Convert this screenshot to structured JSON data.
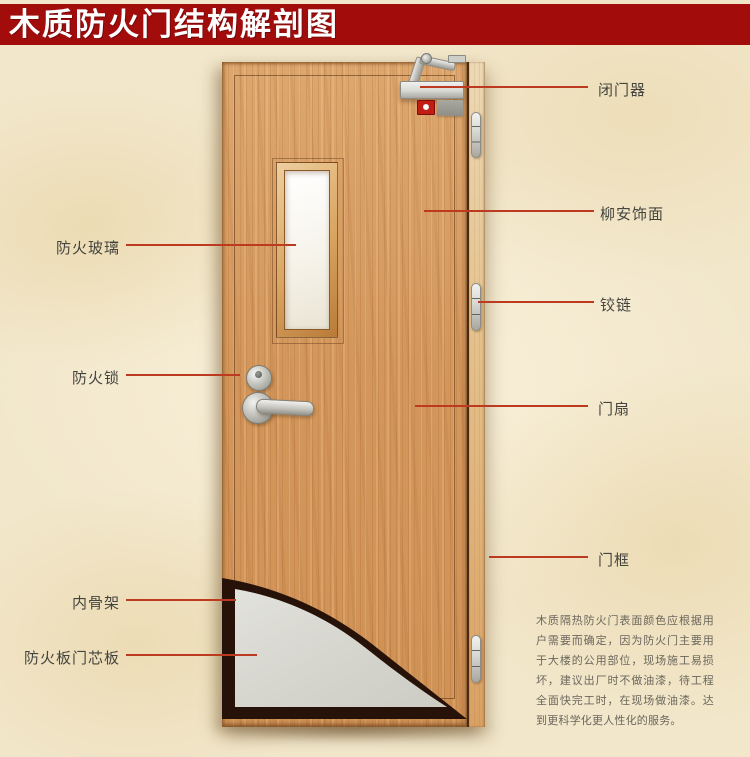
{
  "title": {
    "text": "木质防火门结构解剖图"
  },
  "callouts": {
    "left": [
      {
        "label": "防火玻璃"
      },
      {
        "label": "防火锁"
      },
      {
        "label": "内骨架"
      },
      {
        "label": "防火板门芯板"
      }
    ],
    "right": [
      {
        "label": "闭门器"
      },
      {
        "label": "柳安饰面"
      },
      {
        "label": "铰链"
      },
      {
        "label": "门扇"
      },
      {
        "label": "门框"
      }
    ]
  },
  "note": {
    "text": "木质隔热防火门表面颜色应根据用户需要而确定，因为防火门主要用于大楼的公用部位，现场施工易损坏，建议出厂时不做油漆，待工程全面快完工时，在现场做油漆。达到更科学化更人性化的服务。"
  },
  "colors": {
    "banner": "#a20d0c",
    "callout_line": "#bc3a20",
    "wood": "#d4975b",
    "core_board": "#d9d9d1",
    "inner_frame": "#271209"
  }
}
